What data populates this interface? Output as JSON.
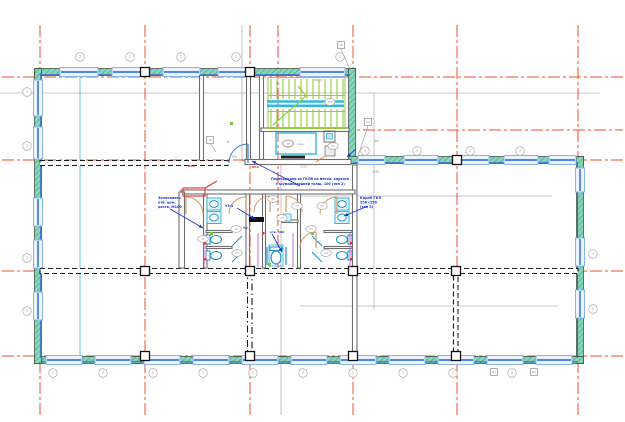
{
  "colors": {
    "grid": "#e8512b",
    "gridDash": "12 3 3 3",
    "gray": "#b5b5b5",
    "teal": "#86d6b8",
    "tealDark": "#43a183",
    "wallEdge": "#3c3c3c",
    "windowFrame": "#8ab4e8",
    "windowFill": "#eaf4fd",
    "windowLine": "#2b5fd9",
    "interior": "#6e6e6e",
    "dashWall": "#1a1a1a",
    "stairGreen": "#97c93d",
    "cyan": "#35b8d8",
    "fixture": "#1f8fd0",
    "fixtureFill": "#e2f3fc",
    "tan": "#cf9a64",
    "annBlue": "#1b2fd4",
    "annRed": "#e53030",
    "magenta": "#c45ad6",
    "greenMark": "#6fc93c",
    "tagGray": "#9a9a9a",
    "dimGray": "#8a8a8a"
  },
  "grid": {
    "vertical": [
      {
        "x": 40,
        "y1": 25,
        "y2": 418
      },
      {
        "x": 145,
        "y1": 25,
        "y2": 418
      },
      {
        "x": 250,
        "y1": 25,
        "y2": 418
      },
      {
        "x": 278,
        "y1": 25,
        "y2": 274
      },
      {
        "x": 353,
        "y1": 25,
        "y2": 418
      },
      {
        "x": 457,
        "y1": 25,
        "y2": 418
      },
      {
        "x": 578,
        "y1": 25,
        "y2": 418
      }
    ],
    "horizontal": [
      {
        "y": 77,
        "x1": 2,
        "x2": 623
      },
      {
        "y": 130,
        "x1": 342,
        "x2": 623
      },
      {
        "y": 160,
        "x1": 2,
        "x2": 623
      },
      {
        "y": 271,
        "x1": 2,
        "x2": 623
      },
      {
        "y": 356,
        "x1": 2,
        "x2": 623
      }
    ]
  },
  "gray_lines": [
    {
      "x1": 242,
      "y1": 25,
      "x2": 242,
      "y2": 161
    },
    {
      "x1": 281,
      "y1": 161,
      "x2": 281,
      "y2": 415
    },
    {
      "x1": 242,
      "y1": 161,
      "x2": 281,
      "y2": 161
    },
    {
      "x1": 374,
      "y1": 93,
      "x2": 374,
      "y2": 310
    },
    {
      "x1": 0,
      "y1": 93,
      "x2": 600,
      "y2": 93
    },
    {
      "x1": 300,
      "y1": 196,
      "x2": 552,
      "y2": 196
    },
    {
      "x1": 300,
      "y1": 306,
      "x2": 558,
      "y2": 306
    }
  ],
  "cyan_guide": {
    "x1": 80,
    "y1": 75,
    "x2": 80,
    "y2": 358
  },
  "exterior_walls": [
    {
      "x": 34.5,
      "y": 68.5,
      "w": 321,
      "h": 7
    },
    {
      "x": 348.5,
      "y": 68.5,
      "w": 7,
      "h": 95
    },
    {
      "x": 348.5,
      "y": 156.5,
      "w": 235,
      "h": 7
    },
    {
      "x": 576.5,
      "y": 156.5,
      "w": 7,
      "h": 207
    },
    {
      "x": 34.5,
      "y": 356.5,
      "w": 549,
      "h": 7
    },
    {
      "x": 34.5,
      "y": 68.5,
      "w": 7,
      "h": 295
    }
  ],
  "inner_face_lines": [
    {
      "x1": 42,
      "y1": 74.8,
      "x2": 350,
      "y2": 74.8
    },
    {
      "x1": 354,
      "y1": 162.8,
      "x2": 578,
      "y2": 162.8
    },
    {
      "x1": 42,
      "y1": 361.8,
      "x2": 578,
      "y2": 361.8
    },
    {
      "x1": 40.8,
      "y1": 74,
      "x2": 40.8,
      "y2": 358
    },
    {
      "x1": 577.5,
      "y1": 162,
      "x2": 577.5,
      "y2": 358
    }
  ],
  "windows": {
    "horizontal": [
      {
        "x1": 60,
        "x2": 98,
        "cy": 72
      },
      {
        "x1": 112,
        "x2": 150,
        "cy": 72
      },
      {
        "x1": 163,
        "x2": 200,
        "cy": 72
      },
      {
        "x1": 218,
        "x2": 255,
        "cy": 72
      },
      {
        "x1": 300,
        "x2": 345,
        "cy": 72
      },
      {
        "x1": 358,
        "x2": 385,
        "cy": 160
      },
      {
        "x1": 404,
        "x2": 438,
        "cy": 160
      },
      {
        "x1": 455,
        "x2": 489,
        "cy": 160
      },
      {
        "x1": 504,
        "x2": 538,
        "cy": 160
      },
      {
        "x1": 549,
        "x2": 576,
        "cy": 160
      },
      {
        "x1": 46,
        "x2": 82,
        "cy": 360
      },
      {
        "x1": 95,
        "x2": 131,
        "cy": 360
      },
      {
        "x1": 144,
        "x2": 180,
        "cy": 360
      },
      {
        "x1": 193,
        "x2": 229,
        "cy": 360
      },
      {
        "x1": 242,
        "x2": 278,
        "cy": 360
      },
      {
        "x1": 291,
        "x2": 327,
        "cy": 360
      },
      {
        "x1": 340,
        "x2": 376,
        "cy": 360
      },
      {
        "x1": 389,
        "x2": 425,
        "cy": 360
      },
      {
        "x1": 438,
        "x2": 474,
        "cy": 360
      },
      {
        "x1": 487,
        "x2": 523,
        "cy": 360
      },
      {
        "x1": 536,
        "x2": 572,
        "cy": 360
      }
    ],
    "vertical": [
      {
        "y1": 80,
        "y2": 116,
        "cx": 38
      },
      {
        "y1": 127,
        "y2": 159,
        "cx": 38
      },
      {
        "y1": 198,
        "y2": 226,
        "cx": 38
      },
      {
        "y1": 240,
        "y2": 268,
        "cx": 38
      },
      {
        "y1": 292,
        "y2": 320,
        "cx": 38
      },
      {
        "y1": 168,
        "y2": 192,
        "cx": 580
      },
      {
        "y1": 238,
        "y2": 266,
        "cx": 580
      },
      {
        "y1": 290,
        "y2": 318,
        "cx": 580
      }
    ]
  },
  "interior_walls": [
    {
      "x": 199.5,
      "y": 75.5,
      "w": 4,
      "h": 85,
      "style": "solid"
    },
    {
      "x": 246.5,
      "y": 75.5,
      "w": 4,
      "h": 85,
      "style": "solid"
    },
    {
      "x": 259.5,
      "y": 75.5,
      "w": 4,
      "h": 85,
      "style": "solid"
    },
    {
      "x": 261,
      "y": 128,
      "w": 88,
      "h": 3.5,
      "style": "solid"
    },
    {
      "x": 245,
      "y": 159.5,
      "w": 106,
      "h": 5,
      "style": "solid"
    },
    {
      "x": 40,
      "y": 160.5,
      "w": 188,
      "h": 5,
      "style": "dashed"
    },
    {
      "x": 40,
      "y": 268.5,
      "w": 538,
      "h": 5,
      "style": "dashed"
    },
    {
      "x": 247.5,
      "y": 273.5,
      "w": 4.5,
      "h": 83,
      "style": "dashdot"
    },
    {
      "x": 352.5,
      "y": 165,
      "w": 4.5,
      "h": 192,
      "style": "solid"
    },
    {
      "x": 453.5,
      "y": 273.5,
      "w": 4.5,
      "h": 83,
      "style": "dashed"
    },
    {
      "x": 181,
      "y": 190,
      "w": 174,
      "h": 4,
      "style": "solid"
    },
    {
      "x": 179,
      "y": 192,
      "w": 5.5,
      "h": 76,
      "style": "solid"
    },
    {
      "x": 203.5,
      "y": 194,
      "w": 3.5,
      "h": 74,
      "style": "solid"
    },
    {
      "x": 246,
      "y": 194,
      "w": 3.5,
      "h": 74,
      "style": "solid"
    },
    {
      "x": 262.5,
      "y": 194,
      "w": 3,
      "h": 74,
      "style": "solid"
    },
    {
      "x": 297.5,
      "y": 194,
      "w": 3,
      "h": 74,
      "style": "solid"
    },
    {
      "x": 206,
      "y": 230.5,
      "w": 26,
      "h": 2,
      "style": "solid"
    },
    {
      "x": 206,
      "y": 246.5,
      "w": 26,
      "h": 2,
      "style": "solid"
    },
    {
      "x": 324,
      "y": 230.5,
      "w": 28,
      "h": 2,
      "style": "solid"
    },
    {
      "x": 324,
      "y": 246.5,
      "w": 28,
      "h": 2,
      "style": "solid"
    },
    {
      "x": 282,
      "y": 220,
      "w": 16,
      "h": 2.5,
      "style": "solid"
    }
  ],
  "columns": [
    [
      145,
      72
    ],
    [
      250,
      72
    ],
    [
      457,
      160
    ],
    [
      145,
      271
    ],
    [
      250,
      271
    ],
    [
      353,
      271
    ],
    [
      456,
      271
    ],
    [
      145,
      356
    ],
    [
      250,
      356
    ],
    [
      353,
      356
    ],
    [
      456,
      356
    ]
  ],
  "stair": {
    "border": [
      268,
      77.5,
      77,
      51
    ],
    "mid_band": [
      268,
      95.5,
      77,
      16
    ],
    "tread_x1": 271,
    "tread_x2": 343,
    "tread_step": 6,
    "tread_rows": [
      [
        79,
        99
      ],
      [
        109,
        127
      ]
    ],
    "landing_lines": [
      [
        267,
        101.5,
        344,
        101.5
      ],
      [
        267,
        105.8,
        344,
        105.8
      ]
    ],
    "diagonal": [
      273,
      125,
      306,
      96
    ],
    "diagonal2": [
      306,
      96,
      298,
      86
    ]
  },
  "lobby": {
    "box": [
      276,
      133,
      40,
      21
    ],
    "bar": [
      281,
      155.5,
      24,
      3
    ],
    "oval": [
      288,
      143.5
    ],
    "oval_label": "14",
    "label": "маш.",
    "label_pos": [
      297,
      145
    ],
    "box2": [
      324,
      131,
      11,
      11
    ],
    "box2_inner": [
      326.5,
      133.5,
      6,
      5.5
    ],
    "box3": [
      325,
      146,
      10,
      10
    ],
    "orange_line": [
      325,
      156,
      316,
      162
    ]
  },
  "fixtures": {
    "sinks": [
      [
        207,
        198
      ],
      [
        207,
        211.5
      ],
      [
        335,
        198
      ],
      [
        335,
        211.5
      ]
    ],
    "sink_w": 14,
    "sink_h": 12,
    "toilets": [
      {
        "ex": 216,
        "ey": 239.5,
        "tx": 206,
        "ty": 235
      },
      {
        "ex": 216,
        "ey": 255.5,
        "tx": 206,
        "ty": 251
      },
      {
        "ex": 342,
        "ey": 239.5,
        "tx": 348,
        "ty": 235
      },
      {
        "ex": 342,
        "ey": 255.5,
        "tx": 348,
        "ty": 251
      }
    ],
    "stall_doors": [
      [
        232,
        246,
        242,
        236
      ],
      [
        232,
        262,
        242,
        252
      ],
      [
        322,
        246,
        312,
        236
      ],
      [
        322,
        262,
        312,
        252
      ]
    ],
    "accessible": {
      "box": [
        269,
        245,
        14,
        21
      ],
      "bowl": [
        276,
        257.5,
        5,
        6.5
      ],
      "tank": [
        270,
        247,
        12,
        3.5
      ],
      "bars": [
        [
          267,
          247,
          267,
          265
        ],
        [
          286,
          247,
          286,
          265
        ]
      ]
    },
    "mid_sink": [
      283,
      214,
      8,
      7
    ],
    "urinal_bar": [
      249,
      217,
      15,
      5
    ],
    "purple": [
      [
        204,
        233,
        204,
        267
      ],
      [
        258,
        233,
        258,
        267
      ],
      [
        293,
        233,
        293,
        267
      ],
      [
        350,
        233,
        350,
        267
      ]
    ],
    "green_marks": [
      [
        230,
        122
      ],
      [
        210,
        232
      ],
      [
        311,
        232
      ],
      [
        268,
        263
      ]
    ],
    "red_marks": [
      [
        204,
        242
      ],
      [
        204,
        258
      ],
      [
        350,
        242
      ],
      [
        350,
        258
      ],
      [
        262,
        232
      ]
    ]
  },
  "door_arcs": [
    {
      "d": "M203,214 A17,17 0 0 0 186,197",
      "leaf": [
        186,
        214,
        186,
        197
      ],
      "c": "tan"
    },
    {
      "d": "M229,214 A17,17 0 0 1 246,197",
      "leaf": [
        246,
        214,
        246,
        197
      ],
      "c": "tan"
    },
    {
      "d": "M254,212 A16,16 0 0 1 270,196",
      "leaf": [
        270,
        212,
        270,
        196
      ],
      "c": "tan"
    },
    {
      "d": "M302,212 A16,16 0 0 0 286,196",
      "leaf": [
        286,
        212,
        286,
        196
      ],
      "c": "tan"
    },
    {
      "d": "M320,214 A17,17 0 0 1 337,197",
      "leaf": [
        337,
        214,
        337,
        197
      ],
      "c": "tan"
    },
    {
      "d": "M300,248 A16,16 0 0 1 316,232",
      "leaf": [
        316,
        248,
        316,
        232
      ],
      "c": "tan"
    },
    {
      "d": "M229,163 A19,19 0 0 1 248,144",
      "leaf": [
        248,
        163,
        248,
        144
      ],
      "c": "blue"
    }
  ],
  "annotations": {
    "blue_texts": [
      {
        "x": 158,
        "y": 199,
        "t": "Зачеканить",
        "s": 3.4
      },
      {
        "x": 158,
        "y": 203.5,
        "t": "отв. цем.",
        "s": 3.4
      },
      {
        "x": 158,
        "y": 208,
        "t": "раств. М100",
        "s": 3.4
      },
      {
        "x": 271,
        "y": 180,
        "t": "Перегородки из ГКЛВ на метал. каркасе",
        "s": 3.3
      },
      {
        "x": 276,
        "y": 184.8,
        "t": "с шумоизоляцией толщ. 100 (тип 2)",
        "s": 3.3
      },
      {
        "x": 360,
        "y": 199,
        "t": "Короб ГКЛ",
        "s": 3.4
      },
      {
        "x": 360,
        "y": 203.5,
        "t": "250×250",
        "s": 3.4
      },
      {
        "x": 360,
        "y": 208,
        "t": "(тип 3)",
        "s": 3.4
      },
      {
        "x": 225,
        "y": 207,
        "t": "У3-1",
        "s": 3.2
      },
      {
        "x": 243,
        "y": 229,
        "t": "ТП",
        "s": 3.0
      },
      {
        "x": 270,
        "y": 233,
        "t": "отв. 100",
        "s": 3.0
      }
    ],
    "red_texts": [
      {
        "x": 252,
        "y": 168,
        "t": "Ø50",
        "s": 3.0
      },
      {
        "x": 188,
        "y": 167,
        "t": "Ø50",
        "s": 3.0
      }
    ],
    "dim_texts": [
      {
        "x": 313,
        "y": 81,
        "t": "300×9"
      },
      {
        "x": 300,
        "y": 167.5,
        "t": "1525"
      },
      {
        "x": 232,
        "y": 157.5,
        "t": "800"
      },
      {
        "x": 372,
        "y": 172.5,
        "t": "4580"
      }
    ],
    "section_marks": [
      {
        "x": 227,
        "y": 143,
        "t": "А"
      },
      {
        "x": 374,
        "y": 142,
        "t": "1А"
      }
    ],
    "blue_leaders": [
      [
        300,
        186,
        252,
        161
      ],
      [
        170,
        209,
        203,
        228
      ],
      [
        368,
        206,
        344,
        216
      ],
      [
        237,
        208,
        255,
        219
      ],
      [
        356,
        149,
        347,
        157
      ],
      [
        272,
        234,
        282,
        252
      ]
    ],
    "red_detail": {
      "rect": [
        183,
        188,
        22,
        8
      ],
      "line": [
        205,
        188,
        217,
        181
      ]
    }
  },
  "tags": {
    "circles": [
      {
        "x": 80,
        "y": 57,
        "l": "2"
      },
      {
        "x": 130,
        "y": 57,
        "l": "2"
      },
      {
        "x": 181,
        "y": 57,
        "l": "2"
      },
      {
        "x": 236,
        "y": 57,
        "l": "2"
      },
      {
        "x": 340,
        "y": 57,
        "l": "2"
      },
      {
        "x": 365,
        "y": 151,
        "l": "2"
      },
      {
        "x": 417,
        "y": 151,
        "l": "2"
      },
      {
        "x": 470,
        "y": 151,
        "l": "2"
      },
      {
        "x": 520,
        "y": 151,
        "l": "2"
      },
      {
        "x": 27,
        "y": 92,
        "l": "2"
      },
      {
        "x": 27,
        "y": 146,
        "l": "2"
      },
      {
        "x": 27,
        "y": 258,
        "l": "2"
      },
      {
        "x": 27,
        "y": 311,
        "l": "2"
      },
      {
        "x": 593,
        "y": 254,
        "l": "2"
      },
      {
        "x": 593,
        "y": 309,
        "l": "2"
      },
      {
        "x": 53,
        "y": 373,
        "l": "2"
      },
      {
        "x": 103,
        "y": 373,
        "l": "2"
      },
      {
        "x": 153,
        "y": 373,
        "l": "2"
      },
      {
        "x": 203,
        "y": 373,
        "l": "2"
      },
      {
        "x": 253,
        "y": 373,
        "l": "2"
      },
      {
        "x": 303,
        "y": 373,
        "l": "2"
      },
      {
        "x": 353,
        "y": 373,
        "l": "2"
      },
      {
        "x": 403,
        "y": 373,
        "l": "2"
      },
      {
        "x": 453,
        "y": 373,
        "l": "2"
      },
      {
        "x": 512,
        "y": 373,
        "l": "2"
      }
    ],
    "squares": [
      {
        "x": 210,
        "y": 140,
        "l": "1Б"
      },
      {
        "x": 341,
        "y": 45,
        "l": "1В"
      },
      {
        "x": 368,
        "y": 122,
        "l": "1А"
      },
      {
        "x": 494,
        "y": 372,
        "l": "Д1"
      },
      {
        "x": 534,
        "y": 372,
        "l": "Д2"
      }
    ],
    "ovals": [
      {
        "x": 288,
        "y": 143.5,
        "l": "14"
      },
      {
        "x": 330,
        "y": 102,
        "l": "ЛК"
      },
      {
        "x": 333,
        "y": 146,
        "l": "15"
      },
      {
        "x": 273,
        "y": 199,
        "l": "16"
      },
      {
        "x": 297,
        "y": 206,
        "l": "17"
      },
      {
        "x": 282,
        "y": 218,
        "l": "18"
      },
      {
        "x": 236,
        "y": 229,
        "l": "19"
      },
      {
        "x": 203,
        "y": 239,
        "l": "20"
      },
      {
        "x": 311,
        "y": 229,
        "l": "21"
      },
      {
        "x": 322,
        "y": 206,
        "l": "22"
      },
      {
        "x": 237,
        "y": 253,
        "l": "23"
      },
      {
        "x": 326,
        "y": 253,
        "l": "24"
      }
    ],
    "gray_leaders": [
      [
        368,
        126,
        358,
        156
      ],
      [
        341,
        49,
        350,
        69
      ],
      [
        210,
        143,
        216,
        152
      ]
    ]
  }
}
